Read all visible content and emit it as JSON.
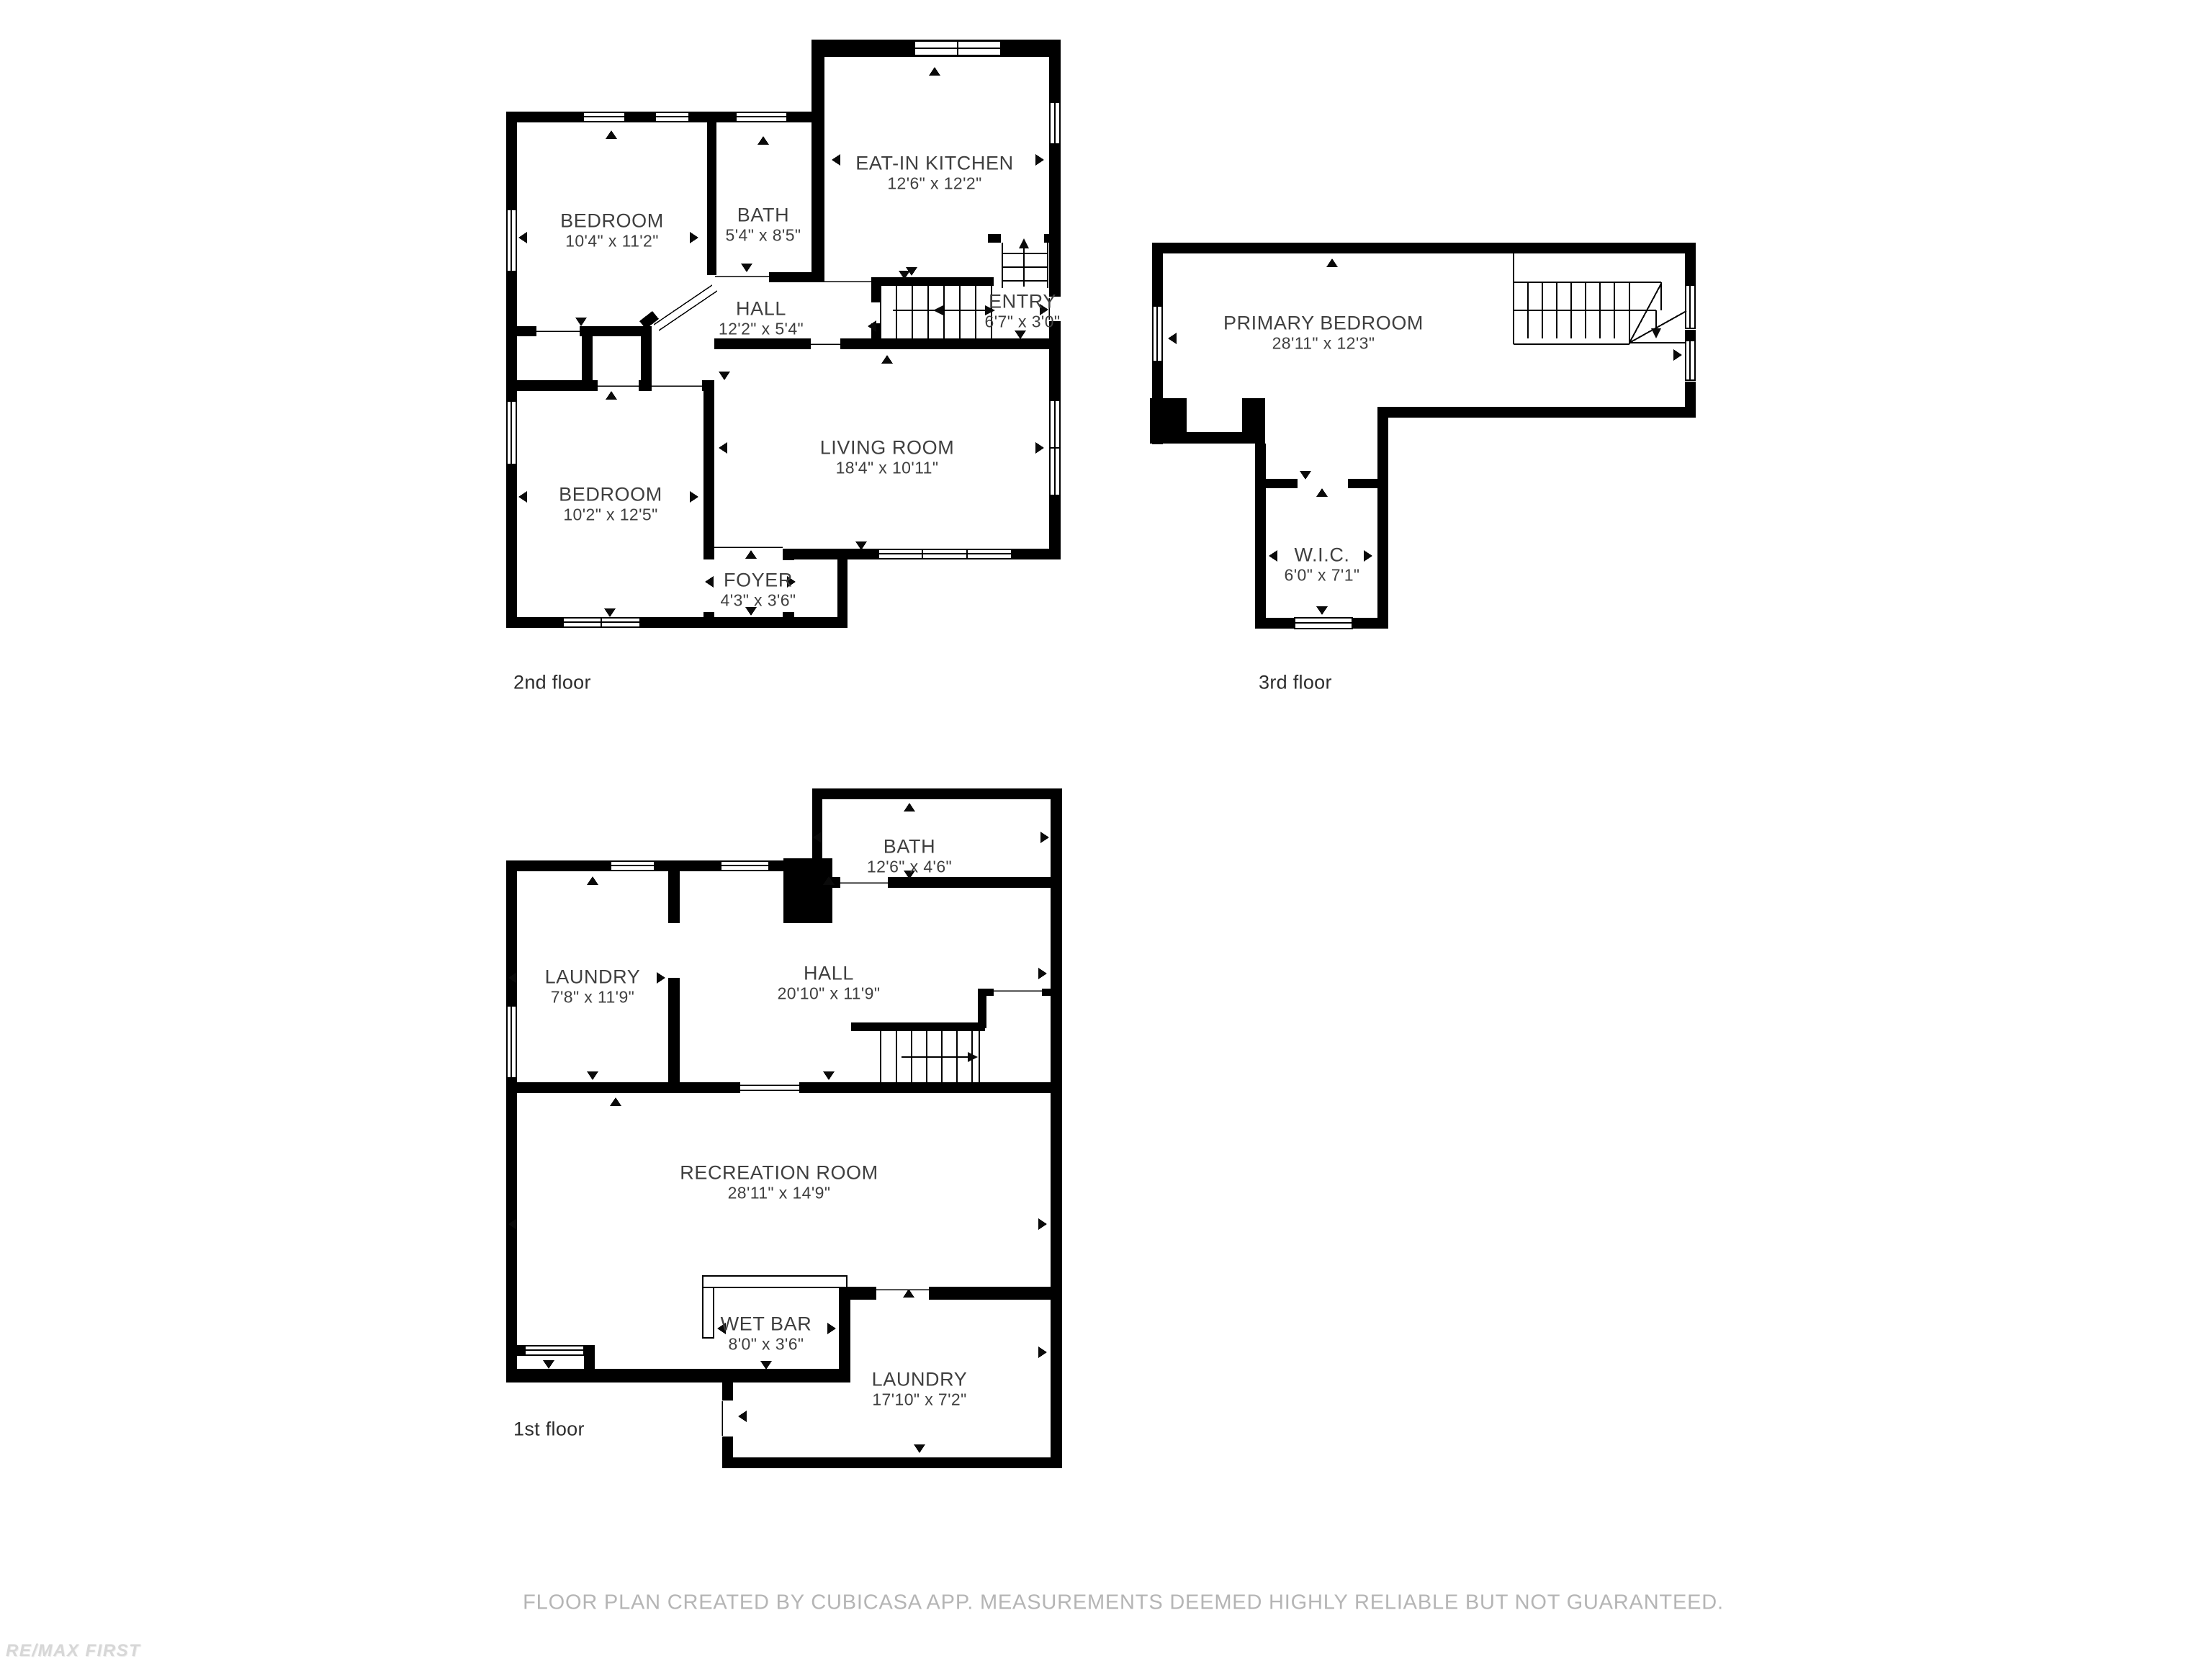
{
  "colors": {
    "background": "#ffffff",
    "wall": "#000000",
    "room_label": "#3f3f3f",
    "caption": "#2d2d2d",
    "disclaimer": "#b5b5b5",
    "watermark": "#d7d7d7"
  },
  "floors": [
    {
      "caption": "2nd floor",
      "rooms": [
        {
          "name": "BEDROOM",
          "dims": "10'4\" x 11'2\""
        },
        {
          "name": "BATH",
          "dims": "5'4\" x 8'5\""
        },
        {
          "name": "EAT-IN KITCHEN",
          "dims": "12'6\" x 12'2\""
        },
        {
          "name": "HALL",
          "dims": "12'2\" x 5'4\""
        },
        {
          "name": "ENTRY",
          "dims": "6'7\" x 3'0\""
        },
        {
          "name": "LIVING ROOM",
          "dims": "18'4\" x 10'11\""
        },
        {
          "name": "BEDROOM",
          "dims": "10'2\" x 12'5\""
        },
        {
          "name": "FOYER",
          "dims": "4'3\" x 3'6\""
        }
      ]
    },
    {
      "caption": "3rd floor",
      "rooms": [
        {
          "name": "PRIMARY BEDROOM",
          "dims": "28'11\" x 12'3\""
        },
        {
          "name": "W.I.C.",
          "dims": "6'0\" x 7'1\""
        }
      ]
    },
    {
      "caption": "1st floor",
      "rooms": [
        {
          "name": "BATH",
          "dims": "12'6\" x 4'6\""
        },
        {
          "name": "LAUNDRY",
          "dims": "7'8\" x 11'9\""
        },
        {
          "name": "HALL",
          "dims": "20'10\" x 11'9\""
        },
        {
          "name": "RECREATION ROOM",
          "dims": "28'11\" x 14'9\""
        },
        {
          "name": "WET BAR",
          "dims": "8'0\" x 3'6\""
        },
        {
          "name": "LAUNDRY",
          "dims": "17'10\" x 7'2\""
        }
      ]
    }
  ],
  "footer": {
    "disclaimer": "FLOOR PLAN CREATED BY CUBICASA APP. MEASUREMENTS DEEMED HIGHLY RELIABLE BUT NOT GUARANTEED."
  },
  "watermark": {
    "text": "RE/MAX FIRST"
  }
}
